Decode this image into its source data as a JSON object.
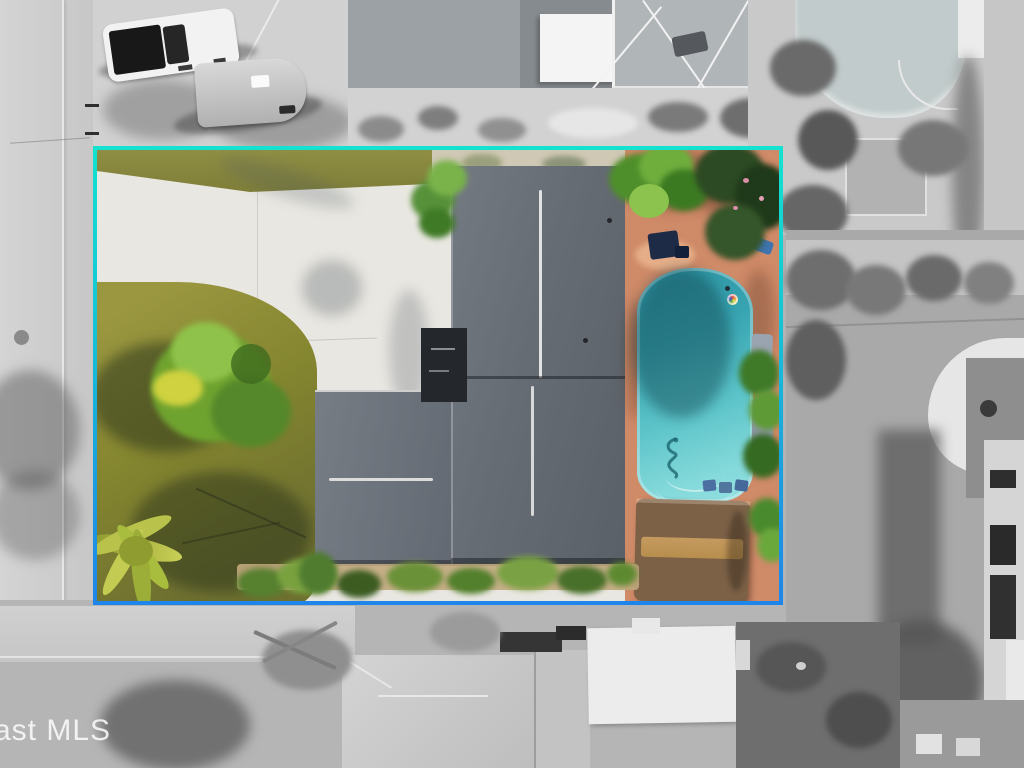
{
  "meta": {
    "type": "aerial-property-photo",
    "description": "Overhead drone photo of a single-family home with swimming pool and tiki hut; the property lot is shown in full color inside a highlighted boundary outline while the surrounding neighborhood is desaturated grayscale.",
    "dimensions": "1024x768"
  },
  "watermark": {
    "text": "ast MLS"
  },
  "boundary": {
    "style": "gradient rectangular outline",
    "color_top": "#12E2CF",
    "color_bottom": "#1E86EA",
    "thickness_px": 4
  },
  "palette": {
    "boundary_top": "#12E2CF",
    "boundary_bottom": "#1E86EA",
    "street_gray": "#CFCFCF",
    "ground_gray": "#B3B3B3",
    "driveway_white": "#E9E7E1",
    "lawn_olive": "#8D8C42",
    "foliage_green": "#5E9A36",
    "palm_yellow": "#C9CF56",
    "roof_dark": "#636970",
    "roof_wing": "#70767D",
    "pool_deck": "#CF8A68",
    "pool_water": "#3AA6B4",
    "pool_water_light": "#8ADCDC",
    "thatch_brown": "#7C6147",
    "thatch_ridge_tan": "#C59A5F",
    "truck_white": "#F2F2F2"
  },
  "scene": {
    "property": {
      "label": "highlighted property lot (color)",
      "features": [
        "gray shingle house roof",
        "white concrete driveway",
        "olive front lawn with bush",
        "yellow-green palm",
        "turquoise swimming pool with seahorse bottom art and steps",
        "rainbow pool float",
        "salmon paver pool deck",
        "thatched tiki hut",
        "patio furniture and loungers",
        "tropical plants along borders"
      ]
    },
    "surroundings": {
      "label": "grayscale neighborhood",
      "features": [
        "street along west side",
        "street along south side",
        "white pickup truck",
        "utility trailer",
        "neighbor house with screen pool enclosure (north)",
        "neighbor pool and wood deck (northeast)",
        "striped-roof house (east)",
        "neighbor houses with ribbed white roof (south)",
        "open lawn with hedges (east)",
        "palm trees and tree shadows"
      ]
    }
  }
}
